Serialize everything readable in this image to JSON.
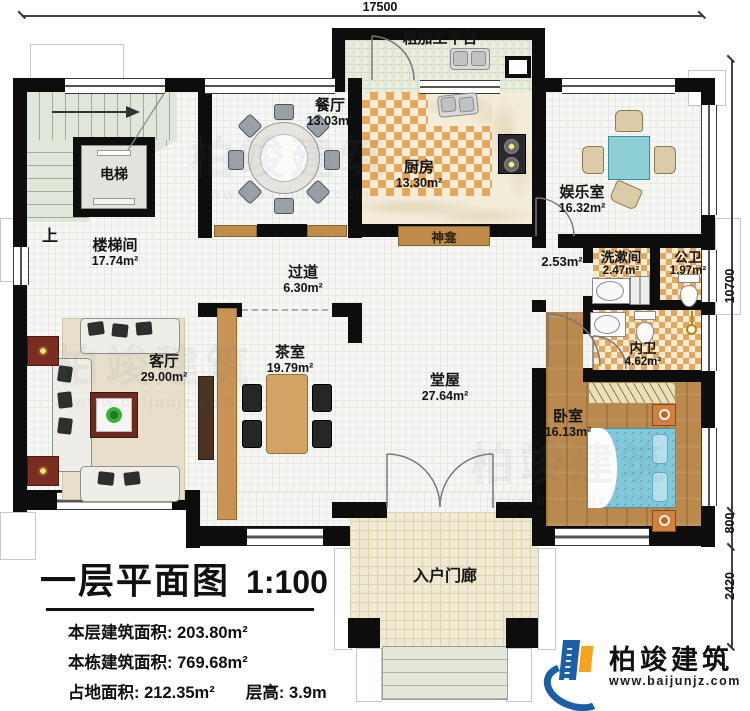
{
  "plan": {
    "dimensions": {
      "top": "17500",
      "right_total": "10700",
      "right_mid": "800",
      "right_bottom": "2420"
    },
    "rooms": {
      "platform": {
        "name": "粗加工平台"
      },
      "dining": {
        "name": "餐厅",
        "area": "13.03m²"
      },
      "kitchen": {
        "name": "厨房",
        "area": "13.30m²"
      },
      "entertainment": {
        "name": "娱乐室",
        "area": "16.32m²"
      },
      "elevator": {
        "name": "电梯"
      },
      "stairwell": {
        "name": "楼梯间",
        "area": "17.74m²"
      },
      "stairs_up": {
        "name": "上"
      },
      "corridor": {
        "name": "过道",
        "area": "6.30m²"
      },
      "shrine": {
        "name": "神龛"
      },
      "side_hall": {
        "area": "2.53m²"
      },
      "washroom": {
        "name": "洗漱间",
        "area": "2.47m²"
      },
      "public_bath": {
        "name": "公卫",
        "area": "1.97m²"
      },
      "private_bath": {
        "name": "内卫",
        "area": "4.62m²"
      },
      "living_room": {
        "name": "客厅",
        "area": "29.00m²"
      },
      "tea_room": {
        "name": "茶室",
        "area": "19.79m²"
      },
      "main_hall": {
        "name": "堂屋",
        "area": "27.64m²"
      },
      "bedroom": {
        "name": "卧室",
        "area": "16.13m²"
      },
      "porch": {
        "name": "入户门廊"
      }
    }
  },
  "title_block": {
    "title": "一层平面图",
    "scale": "1:100",
    "floor_area_label": "本层建筑面积:",
    "floor_area": "203.80m²",
    "building_area_label": "本栋建筑面积:",
    "building_area": "769.68m²",
    "footprint_label": "占地面积:",
    "footprint": "212.35m²",
    "height_label": "层高:",
    "height": "3.9m"
  },
  "brand": {
    "name": "柏竣建筑",
    "website": "www.baijunjz.com"
  },
  "watermark": {
    "text": "柏竣建筑",
    "website": "www.baijunjz.com"
  },
  "colors": {
    "wall": "#0d0d0d",
    "checker": "#e2a75f",
    "wood": "#b9894e",
    "bed": "#83c7da",
    "brand_blue": "#1c5fa8",
    "brand_orange": "#f5a21d"
  }
}
